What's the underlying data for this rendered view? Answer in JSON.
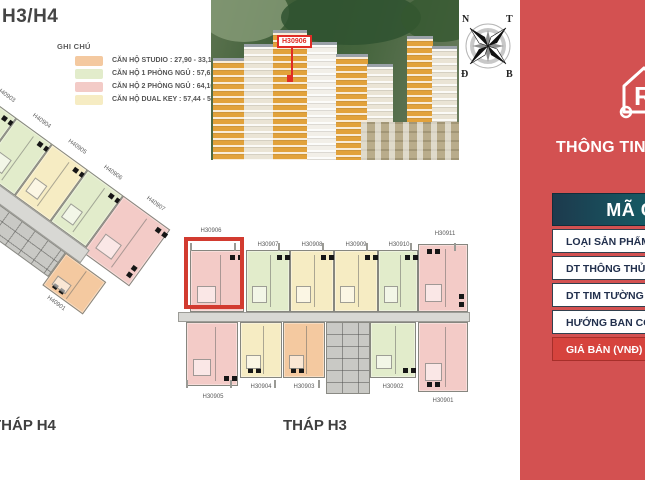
{
  "title": "H3/H4",
  "legend": {
    "heading": "GHI CHÚ",
    "items": [
      {
        "type": "studio",
        "color": "#f4c9a0",
        "label": "CĂN HỘ STUDIO : 27,90 - 33,16 m2"
      },
      {
        "type": "one_bedroom",
        "color": "#e2eccb",
        "label": "CĂN HỘ 1 PHÒNG NGỦ : 57,61 - 57,96 m2"
      },
      {
        "type": "two_bedroom",
        "color": "#f3cbc7",
        "label": "CĂN HỘ 2 PHÒNG NGỦ : 64,10 - 70,45 m2"
      },
      {
        "type": "dual_key",
        "color": "#f6ecc3",
        "label": "CĂN HỘ DUAL KEY : 57,44 - 57,71 m2"
      }
    ]
  },
  "photo": {
    "marker_label": "H30906"
  },
  "compass": {
    "nw": "N",
    "ne": "T",
    "sw": "Đ",
    "se": "B"
  },
  "info_panel": {
    "heading": "THÔNG TIN C",
    "accent_color": "#d35151",
    "table": {
      "header": "MÃ CĂ",
      "rows": [
        {
          "label": "LOẠI SẢN PHẨM"
        },
        {
          "label": "DT THÔNG THỦY (M"
        },
        {
          "label": "DT TIM TƯỜNG (M2"
        },
        {
          "label": "HƯỚNG BAN CÔNG"
        }
      ],
      "price_label": "GIÁ BÁN (VNĐ)",
      "price_color": "#d6433d"
    }
  },
  "towers": {
    "h4": {
      "name": "THÁP H4",
      "units": [
        {
          "id": "H40903",
          "type": "one_bedroom"
        },
        {
          "id": "H40904",
          "type": "one_bedroom"
        },
        {
          "id": "H40905",
          "type": "dual_key"
        },
        {
          "id": "H40906",
          "type": "one_bedroom"
        },
        {
          "id": "H40907",
          "type": "two_bedroom"
        },
        {
          "id": "H40901",
          "type": "studio"
        }
      ]
    },
    "h3": {
      "name": "THÁP H3",
      "selected_unit": "H30906",
      "top_units": [
        {
          "id": "H30906",
          "type": "two_bedroom",
          "highlighted": true
        },
        {
          "id": "H30907",
          "type": "one_bedroom"
        },
        {
          "id": "H30908",
          "type": "dual_key"
        },
        {
          "id": "H30909",
          "type": "dual_key"
        },
        {
          "id": "H30910",
          "type": "one_bedroom"
        },
        {
          "id": "H30911",
          "type": "two_bedroom"
        }
      ],
      "bottom_units": [
        {
          "id": "H30905",
          "type": "two_bedroom"
        },
        {
          "id": "H30904",
          "type": "dual_key"
        },
        {
          "id": "H30903",
          "type": "studio"
        },
        {
          "id": "H30902",
          "type": "one_bedroom"
        },
        {
          "id": "H30901",
          "type": "two_bedroom"
        }
      ]
    }
  },
  "colors": {
    "highlight_red": "#d23b30",
    "panel_red": "#d35151",
    "header_gradient_left": "#1d3a4d",
    "header_gradient_right": "#117a72"
  }
}
